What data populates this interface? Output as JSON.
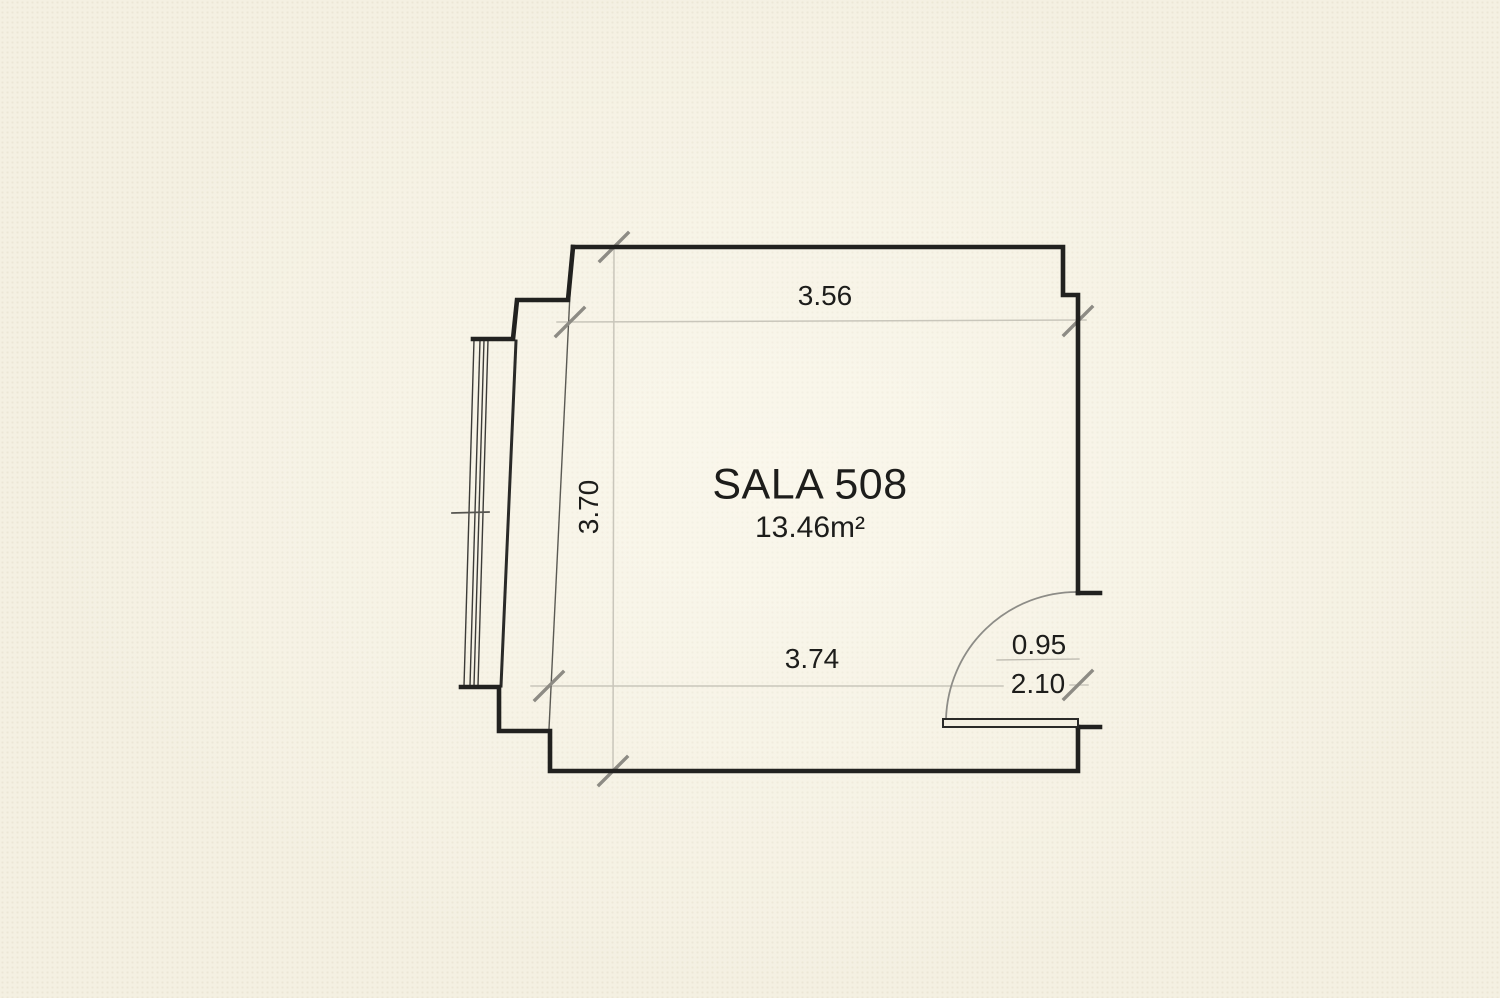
{
  "floor_plan": {
    "room": {
      "name": "SALA 508",
      "area": "13.46m²"
    },
    "dimensions": {
      "top_width": "3.56",
      "left_height": "3.70",
      "bottom_width": "3.74",
      "door_width": "0.95",
      "door_height": "2.10"
    },
    "colors": {
      "background": "#f4f0e2",
      "wall_line": "#21211f",
      "window_line": "#3c3b38",
      "dimension_line": "#c9c6bb",
      "extension_line": "#5a5953",
      "tick_mark": "#8d8b84",
      "door_arc": "#8d8c87",
      "text": "#1d1d1b"
    }
  }
}
